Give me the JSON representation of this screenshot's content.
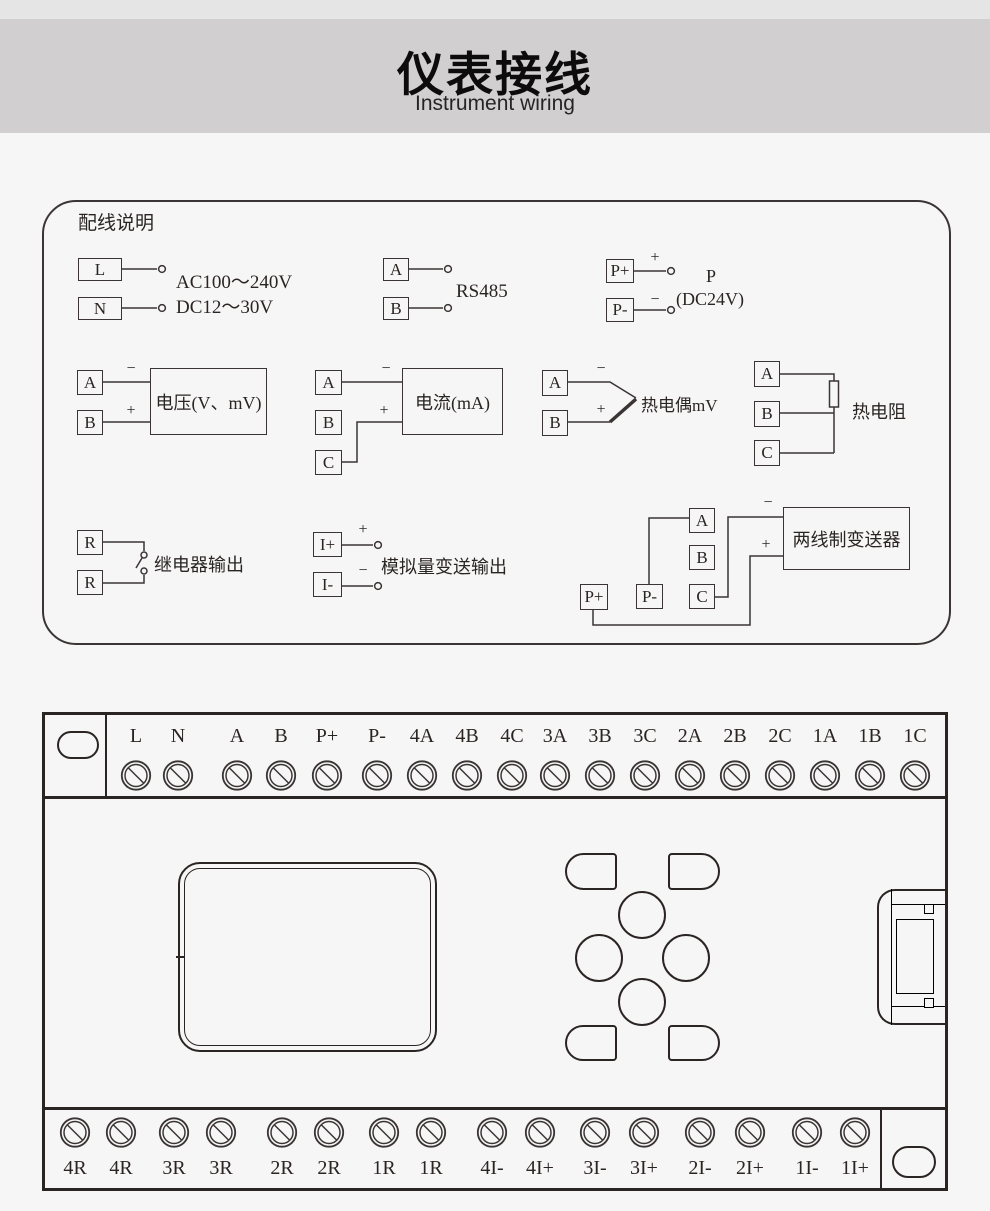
{
  "header": {
    "title": "仪表接线",
    "subtitle": "Instrument wiring"
  },
  "wiring": {
    "title": "配线说明",
    "signs": {
      "plus": "+",
      "minus": "−"
    },
    "power": {
      "t1": "L",
      "t2": "N",
      "line1": "AC100～240V",
      "line2": "DC12～30V"
    },
    "rs485": {
      "t1": "A",
      "t2": "B",
      "label": "RS485"
    },
    "dc_out": {
      "t1": "P+",
      "t2": "P-",
      "name": "P",
      "volt": "(DC24V)"
    },
    "voltage": {
      "t1": "A",
      "t2": "B",
      "label": "电压(V、mV)"
    },
    "current": {
      "t1": "A",
      "t2": "B",
      "t3": "C",
      "label": "电流(mA)"
    },
    "thermocouple": {
      "t1": "A",
      "t2": "B",
      "label": "热电偶mV"
    },
    "rtd": {
      "t1": "A",
      "t2": "B",
      "t3": "C",
      "label": "热电阻"
    },
    "relay": {
      "t1": "R",
      "t2": "R",
      "label": "继电器输出"
    },
    "analog_out": {
      "t1": "I+",
      "t2": "I-",
      "label": "模拟量变送输出"
    },
    "transmitter": {
      "tA": "A",
      "tB": "B",
      "tC": "C",
      "tPplus": "P+",
      "tPminus": "P-",
      "label": "两线制变送器"
    }
  },
  "terminal_block": {
    "top_row": [
      "L",
      "N",
      "A",
      "B",
      "P+",
      "P-",
      "4A",
      "4B",
      "4C",
      "3A",
      "3B",
      "3C",
      "2A",
      "2B",
      "2C",
      "1A",
      "1B",
      "1C"
    ],
    "bottom_row": [
      "4R",
      "4R",
      "3R",
      "3R",
      "2R",
      "2R",
      "1R",
      "1R",
      "4I-",
      "4I+",
      "3I-",
      "3I+",
      "2I-",
      "2I+",
      "1I-",
      "1I+"
    ]
  }
}
